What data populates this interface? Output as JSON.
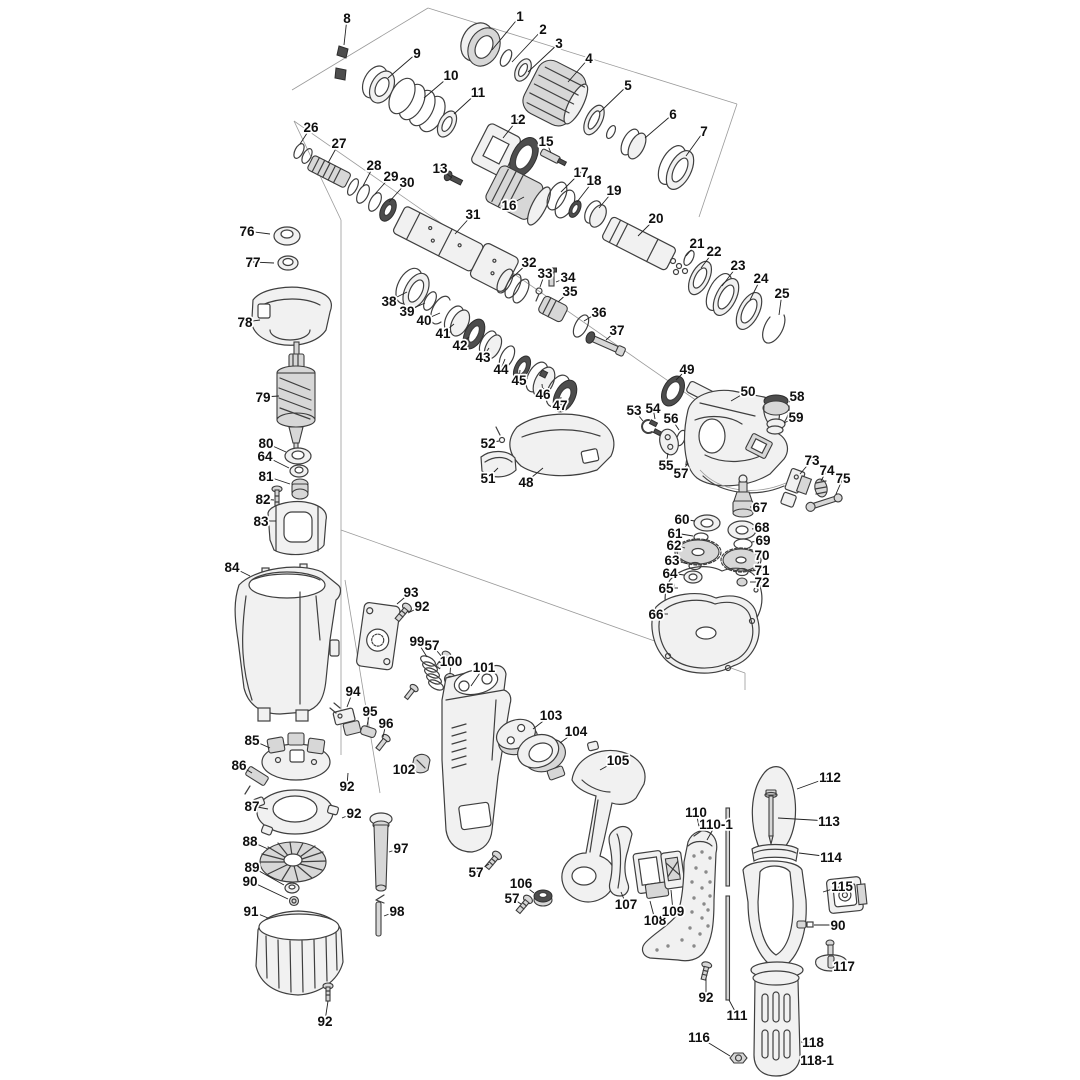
{
  "diagram": {
    "type": "exploded-parts-diagram",
    "subject": "rotary hammer drill exploded view parts schematic",
    "background_color": "#ffffff",
    "line_color": "#3f3f3f",
    "label_color": "#0f0f0f",
    "labels": [
      {
        "n": "1",
        "x": 520,
        "y": 16,
        "tx": 492,
        "ty": 50
      },
      {
        "n": "2",
        "x": 543,
        "y": 29,
        "tx": 512,
        "ty": 62
      },
      {
        "n": "3",
        "x": 559,
        "y": 43,
        "tx": 528,
        "ty": 72
      },
      {
        "n": "4",
        "x": 589,
        "y": 58,
        "tx": 568,
        "ty": 82
      },
      {
        "n": "5",
        "x": 628,
        "y": 85,
        "tx": 600,
        "ty": 112
      },
      {
        "n": "6",
        "x": 673,
        "y": 114,
        "tx": 645,
        "ty": 138
      },
      {
        "n": "7",
        "x": 704,
        "y": 131,
        "tx": 686,
        "ty": 156
      },
      {
        "n": "8",
        "x": 347,
        "y": 18,
        "tx": 344,
        "ty": 45
      },
      {
        "n": "9",
        "x": 417,
        "y": 53,
        "tx": 388,
        "ty": 78
      },
      {
        "n": "10",
        "x": 451,
        "y": 75,
        "tx": 424,
        "ty": 98
      },
      {
        "n": "11",
        "x": 478,
        "y": 92,
        "tx": 454,
        "ty": 114
      },
      {
        "n": "12",
        "x": 518,
        "y": 119,
        "tx": 503,
        "ty": 138
      },
      {
        "n": "13",
        "x": 440,
        "y": 168,
        "tx": 452,
        "ty": 178
      },
      {
        "n": "15",
        "x": 546,
        "y": 141,
        "tx": 551,
        "ty": 153
      },
      {
        "n": "16",
        "x": 509,
        "y": 205,
        "tx": 524,
        "ty": 197
      },
      {
        "n": "17",
        "x": 581,
        "y": 172,
        "tx": 561,
        "ty": 192
      },
      {
        "n": "18",
        "x": 594,
        "y": 180,
        "tx": 577,
        "ty": 202
      },
      {
        "n": "19",
        "x": 614,
        "y": 190,
        "tx": 599,
        "ty": 208
      },
      {
        "n": "20",
        "x": 656,
        "y": 218,
        "tx": 638,
        "ty": 236
      },
      {
        "n": "21",
        "x": 697,
        "y": 243,
        "tx": 686,
        "ty": 256
      },
      {
        "n": "22",
        "x": 714,
        "y": 251,
        "tx": 701,
        "ty": 268
      },
      {
        "n": "23",
        "x": 738,
        "y": 265,
        "tx": 722,
        "ty": 286
      },
      {
        "n": "24",
        "x": 761,
        "y": 278,
        "tx": 750,
        "ty": 300
      },
      {
        "n": "25",
        "x": 782,
        "y": 293,
        "tx": 779,
        "ty": 315
      },
      {
        "n": "26",
        "x": 311,
        "y": 127,
        "tx": 300,
        "ty": 144
      },
      {
        "n": "27",
        "x": 339,
        "y": 143,
        "tx": 328,
        "ty": 163
      },
      {
        "n": "28",
        "x": 374,
        "y": 165,
        "tx": 363,
        "ty": 186
      },
      {
        "n": "29",
        "x": 391,
        "y": 176,
        "tx": 375,
        "ty": 194
      },
      {
        "n": "30",
        "x": 407,
        "y": 182,
        "tx": 389,
        "ty": 202
      },
      {
        "n": "31",
        "x": 473,
        "y": 214,
        "tx": 455,
        "ty": 234
      },
      {
        "n": "32",
        "x": 529,
        "y": 262,
        "tx": 513,
        "ty": 277
      },
      {
        "n": "33",
        "x": 545,
        "y": 273,
        "tx": 540,
        "ty": 287
      },
      {
        "n": "34",
        "x": 568,
        "y": 277,
        "tx": 556,
        "ty": 282
      },
      {
        "n": "35",
        "x": 570,
        "y": 291,
        "tx": 558,
        "ty": 302
      },
      {
        "n": "36",
        "x": 599,
        "y": 312,
        "tx": 584,
        "ty": 321
      },
      {
        "n": "37",
        "x": 617,
        "y": 330,
        "tx": 606,
        "ty": 340
      },
      {
        "n": "38",
        "x": 389,
        "y": 301,
        "tx": 407,
        "ty": 292
      },
      {
        "n": "39",
        "x": 407,
        "y": 311,
        "tx": 425,
        "ty": 303
      },
      {
        "n": "40",
        "x": 424,
        "y": 320,
        "tx": 440,
        "ty": 313
      },
      {
        "n": "41",
        "x": 443,
        "y": 333,
        "tx": 454,
        "ty": 324
      },
      {
        "n": "42",
        "x": 460,
        "y": 345,
        "tx": 469,
        "ty": 337
      },
      {
        "n": "43",
        "x": 483,
        "y": 357,
        "tx": 489,
        "ty": 348
      },
      {
        "n": "44",
        "x": 501,
        "y": 369,
        "tx": 505,
        "ty": 359
      },
      {
        "n": "45",
        "x": 519,
        "y": 380,
        "tx": 520,
        "ty": 370
      },
      {
        "n": "46",
        "x": 543,
        "y": 394,
        "tx": 542,
        "ty": 384
      },
      {
        "n": "47",
        "x": 560,
        "y": 405,
        "tx": 561,
        "ty": 397
      },
      {
        "n": "48",
        "x": 526,
        "y": 482,
        "tx": 543,
        "ty": 468
      },
      {
        "n": "49",
        "x": 687,
        "y": 369,
        "tx": 676,
        "ty": 380
      },
      {
        "n": "50",
        "x": 748,
        "y": 391,
        "tx": 731,
        "ty": 401
      },
      {
        "n": "51",
        "x": 488,
        "y": 478,
        "tx": 498,
        "ty": 468
      },
      {
        "n": "52",
        "x": 488,
        "y": 443,
        "tx": 499,
        "ty": 441
      },
      {
        "n": "53",
        "x": 634,
        "y": 410,
        "tx": 643,
        "ty": 421
      },
      {
        "n": "54",
        "x": 653,
        "y": 408,
        "tx": 655,
        "ty": 419
      },
      {
        "n": "55",
        "x": 666,
        "y": 465,
        "tx": 668,
        "ty": 453
      },
      {
        "n": "56",
        "x": 671,
        "y": 418,
        "tx": 679,
        "ty": 430
      },
      {
        "n": "57",
        "x": 681,
        "y": 473,
        "tx": 688,
        "ty": 463
      },
      {
        "n": "58",
        "x": 797,
        "y": 396,
        "tx": 789,
        "ty": 402
      },
      {
        "n": "59",
        "x": 796,
        "y": 417,
        "tx": 784,
        "ty": 423
      },
      {
        "n": "60",
        "x": 682,
        "y": 519,
        "tx": 695,
        "ty": 521
      },
      {
        "n": "61",
        "x": 675,
        "y": 533,
        "tx": 693,
        "ty": 536
      },
      {
        "n": "62",
        "x": 674,
        "y": 545,
        "tx": 685,
        "ty": 548
      },
      {
        "n": "63",
        "x": 672,
        "y": 560,
        "tx": 688,
        "ty": 564
      },
      {
        "n": "64",
        "x": 670,
        "y": 573,
        "tx": 684,
        "ty": 575
      },
      {
        "n": "65",
        "x": 666,
        "y": 588,
        "tx": 678,
        "ty": 588
      },
      {
        "n": "66",
        "x": 656,
        "y": 614,
        "tx": 668,
        "ty": 614
      },
      {
        "n": "67",
        "x": 760,
        "y": 507,
        "tx": 750,
        "ty": 507
      },
      {
        "n": "68",
        "x": 762,
        "y": 527,
        "tx": 752,
        "ty": 529
      },
      {
        "n": "69",
        "x": 763,
        "y": 540,
        "tx": 752,
        "ty": 542
      },
      {
        "n": "70",
        "x": 762,
        "y": 555,
        "tx": 756,
        "ty": 557
      },
      {
        "n": "71",
        "x": 762,
        "y": 570,
        "tx": 750,
        "ty": 571
      },
      {
        "n": "72",
        "x": 762,
        "y": 582,
        "tx": 750,
        "ty": 582
      },
      {
        "n": "73",
        "x": 812,
        "y": 460,
        "tx": 800,
        "ty": 474
      },
      {
        "n": "74",
        "x": 827,
        "y": 470,
        "tx": 821,
        "ty": 481
      },
      {
        "n": "75",
        "x": 843,
        "y": 478,
        "tx": 836,
        "ty": 494
      },
      {
        "n": "76",
        "x": 247,
        "y": 231,
        "tx": 270,
        "ty": 234
      },
      {
        "n": "77",
        "x": 253,
        "y": 262,
        "tx": 274,
        "ty": 263
      },
      {
        "n": "78",
        "x": 245,
        "y": 322,
        "tx": 260,
        "ty": 320
      },
      {
        "n": "79",
        "x": 263,
        "y": 397,
        "tx": 279,
        "ty": 396
      },
      {
        "n": "80",
        "x": 266,
        "y": 443,
        "tx": 286,
        "ty": 452
      },
      {
        "n": "64",
        "x": 265,
        "y": 456,
        "tx": 289,
        "ty": 468
      },
      {
        "n": "81",
        "x": 266,
        "y": 476,
        "tx": 290,
        "ty": 484
      },
      {
        "n": "82",
        "x": 263,
        "y": 499,
        "tx": 274,
        "ty": 500
      },
      {
        "n": "83",
        "x": 261,
        "y": 521,
        "tx": 276,
        "ty": 521
      },
      {
        "n": "84",
        "x": 232,
        "y": 567,
        "tx": 250,
        "ty": 576
      },
      {
        "n": "85",
        "x": 252,
        "y": 740,
        "tx": 270,
        "ty": 748
      },
      {
        "n": "86",
        "x": 239,
        "y": 765,
        "tx": 252,
        "ty": 773
      },
      {
        "n": "87",
        "x": 252,
        "y": 806,
        "tx": 268,
        "ty": 809
      },
      {
        "n": "88",
        "x": 250,
        "y": 841,
        "tx": 268,
        "ty": 849
      },
      {
        "n": "89",
        "x": 252,
        "y": 867,
        "tx": 284,
        "ty": 885
      },
      {
        "n": "90",
        "x": 250,
        "y": 881,
        "tx": 288,
        "ty": 899
      },
      {
        "n": "91",
        "x": 251,
        "y": 911,
        "tx": 268,
        "ty": 918
      },
      {
        "n": "92",
        "x": 422,
        "y": 606,
        "tx": 408,
        "ty": 613
      },
      {
        "n": "92",
        "x": 347,
        "y": 786,
        "tx": 348,
        "ty": 773
      },
      {
        "n": "92",
        "x": 354,
        "y": 813,
        "tx": 342,
        "ty": 818
      },
      {
        "n": "92",
        "x": 325,
        "y": 1021,
        "tx": 328,
        "ty": 1001
      },
      {
        "n": "92",
        "x": 706,
        "y": 997,
        "tx": 706,
        "ty": 978
      },
      {
        "n": "93",
        "x": 411,
        "y": 592,
        "tx": 397,
        "ty": 604
      },
      {
        "n": "94",
        "x": 353,
        "y": 691,
        "tx": 347,
        "ty": 707
      },
      {
        "n": "95",
        "x": 370,
        "y": 711,
        "tx": 367,
        "ty": 726
      },
      {
        "n": "96",
        "x": 386,
        "y": 723,
        "tx": 383,
        "ty": 737
      },
      {
        "n": "97",
        "x": 401,
        "y": 848,
        "tx": 389,
        "ty": 852
      },
      {
        "n": "98",
        "x": 397,
        "y": 911,
        "tx": 384,
        "ty": 916
      },
      {
        "n": "99",
        "x": 417,
        "y": 641,
        "tx": 427,
        "ty": 657
      },
      {
        "n": "57",
        "x": 432,
        "y": 645,
        "tx": 442,
        "ty": 657
      },
      {
        "n": "100",
        "x": 451,
        "y": 661,
        "tx": 450,
        "ty": 674
      },
      {
        "n": "101",
        "x": 484,
        "y": 667,
        "tx": 471,
        "ty": 686
      },
      {
        "n": "102",
        "x": 404,
        "y": 769,
        "tx": 415,
        "ty": 764
      },
      {
        "n": "103",
        "x": 551,
        "y": 715,
        "tx": 533,
        "ty": 729
      },
      {
        "n": "104",
        "x": 576,
        "y": 731,
        "tx": 560,
        "ty": 743
      },
      {
        "n": "105",
        "x": 618,
        "y": 760,
        "tx": 600,
        "ty": 770
      },
      {
        "n": "106",
        "x": 521,
        "y": 883,
        "tx": 534,
        "ty": 893
      },
      {
        "n": "57",
        "x": 476,
        "y": 872,
        "tx": 489,
        "ty": 864
      },
      {
        "n": "57",
        "x": 512,
        "y": 898,
        "tx": 521,
        "ty": 904
      },
      {
        "n": "107",
        "x": 626,
        "y": 904,
        "tx": 621,
        "ty": 892
      },
      {
        "n": "108",
        "x": 655,
        "y": 920,
        "tx": 650,
        "ty": 901
      },
      {
        "n": "109",
        "x": 673,
        "y": 911,
        "tx": 671,
        "ty": 890
      },
      {
        "n": "110",
        "x": 696,
        "y": 812,
        "tx": 700,
        "ty": 831
      },
      {
        "n": "110-1",
        "x": 716,
        "y": 824,
        "tx": 707,
        "ty": 840
      },
      {
        "n": "111",
        "x": 737,
        "y": 1015,
        "tx": 729,
        "ty": 1000
      },
      {
        "n": "112",
        "x": 830,
        "y": 777,
        "tx": 797,
        "ty": 789
      },
      {
        "n": "113",
        "x": 829,
        "y": 821,
        "tx": 778,
        "ty": 818
      },
      {
        "n": "114",
        "x": 831,
        "y": 857,
        "tx": 799,
        "ty": 853
      },
      {
        "n": "115",
        "x": 842,
        "y": 886,
        "tx": 823,
        "ty": 892
      },
      {
        "n": "90",
        "x": 838,
        "y": 925,
        "tx": 814,
        "ty": 925
      },
      {
        "n": "116",
        "x": 699,
        "y": 1037,
        "tx": 730,
        "ty": 1056
      },
      {
        "n": "117",
        "x": 844,
        "y": 966,
        "tx": 833,
        "ty": 961
      },
      {
        "n": "118",
        "x": 813,
        "y": 1042,
        "tx": 801,
        "ty": 1042
      },
      {
        "n": "118-1",
        "x": 817,
        "y": 1060,
        "tx": 800,
        "ty": 1056
      }
    ]
  }
}
